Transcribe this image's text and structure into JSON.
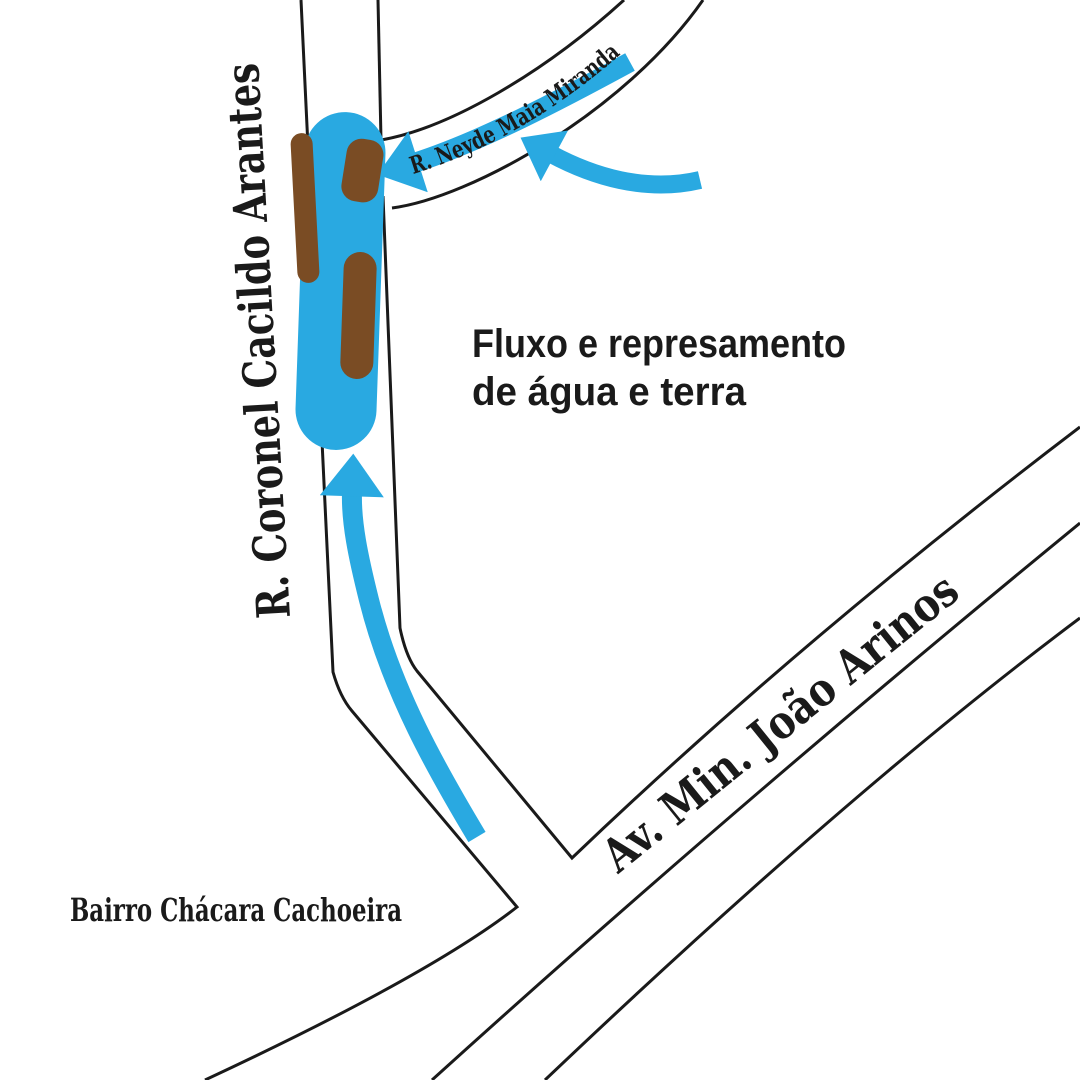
{
  "labels": {
    "street_vertical": "R. Coronel Cacildo Arantes",
    "street_curved": "R. Neyde Maia Miranda",
    "avenue_diagonal": "Av. Min. João Arinos",
    "neighborhood": "Bairro Chácara Cachoeira",
    "annotation_line1": "Fluxo e represamento",
    "annotation_line2": "de água e terra"
  },
  "colors": {
    "flow": "#29a9e1",
    "earth": "#7a4c24",
    "road_line": "#1a1a1a",
    "text": "#1a1a1a",
    "background": "#ffffff"
  }
}
